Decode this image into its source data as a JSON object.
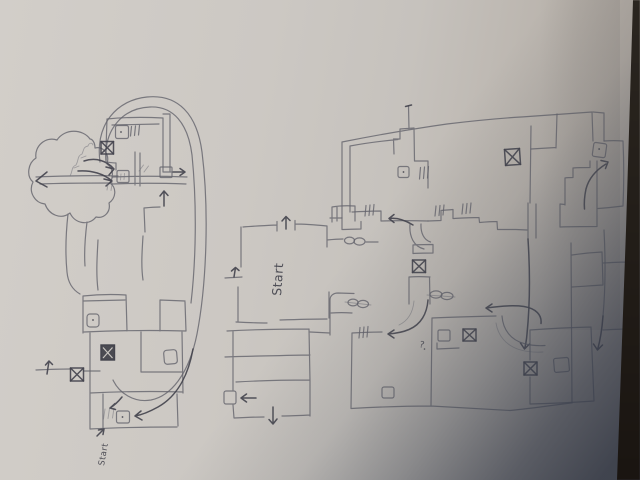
{
  "scene": {
    "description": "Photograph of two hand-drawn video game level maps sketched in pencil on a sheet of paper; a dark table edge is visible along the right side and a soft bluish shadow falls over the bottom-right corner",
    "paper_color": "#cbc7c2",
    "pencil_color": "#63636c",
    "pencil_dark_color": "#43434c",
    "shadow_color": "#3d4450",
    "table_color": "#1d1915"
  },
  "left_map": {
    "description": "small level sketch encircled by a large looping oval; cloud-shaped cave room on the left, stacked rooms with crossed boxes, item boxes and arrows below",
    "start_label": "Start",
    "marker_counts": {
      "x_boxes": 3,
      "item_boxes": 6,
      "hatch_door_marks": 4,
      "arrows": 9
    }
  },
  "right_map": {
    "description": "large level sketch of many rectangular rooms joined by corridors in two rows, with a labelled start room on the left wing",
    "start_label": "Start",
    "question_mark": "?",
    "marker_counts": {
      "x_boxes": 4,
      "item_boxes": 6,
      "pill_door_marks": 3,
      "hatch_door_marks": 5,
      "arrows": 10
    }
  }
}
